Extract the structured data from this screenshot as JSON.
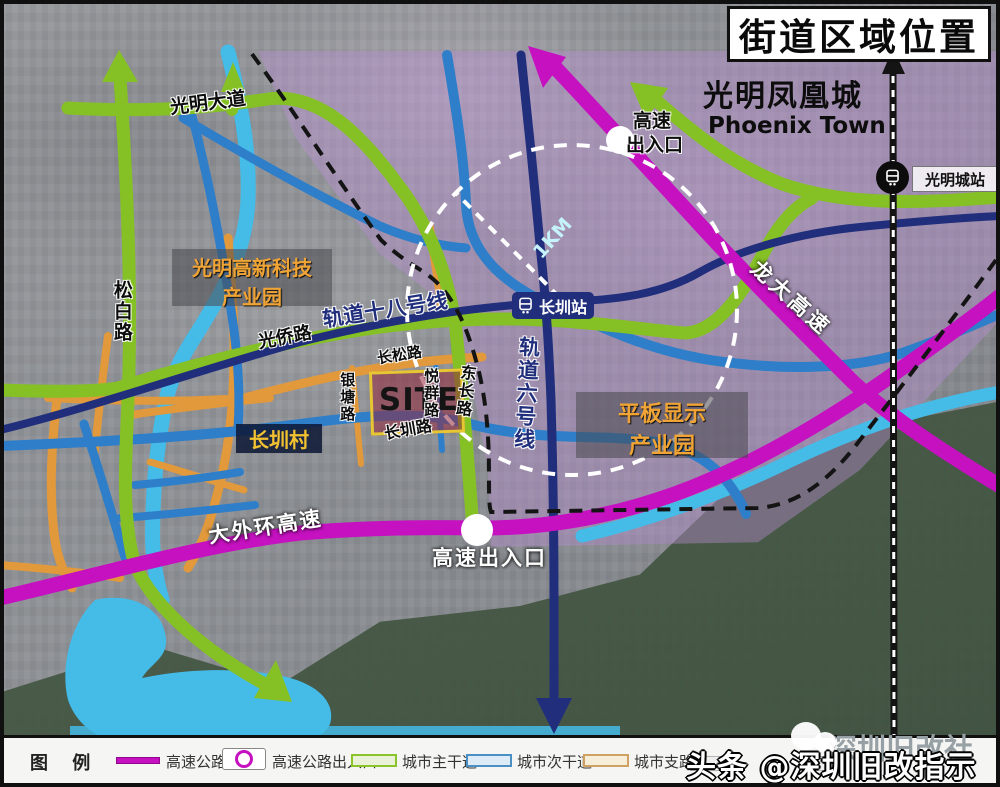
{
  "title": "街道区域位置",
  "areas": {
    "phoenix_cn": "光明凤凰城",
    "phoenix_en": "Phoenix Town",
    "hightech_park_line1": "光明高新科技",
    "hightech_park_line2": "产业园",
    "flatpanel_park_line1": "平板显示",
    "flatpanel_park_line2": "产业园",
    "changzhen_village": "长圳村",
    "site": "SITE"
  },
  "roads": {
    "guangming_avenue": "光明大道",
    "songbai_road": "松白路",
    "guangqiao_road": "光侨路",
    "changsong_road": "长松路",
    "yintang_road": "银塘路",
    "yuequn_road": "悦群路",
    "dongchang_road": "东长路",
    "changzhen_road": "长圳路",
    "dawaihuan_expressway": "大外环高速",
    "longda_expressway": "龙大高速"
  },
  "metro": {
    "line18": "轨道十八号线",
    "line6": "轨道六号线",
    "changzhen_station": "长圳站",
    "guangmingcheng_station": "光明城站"
  },
  "markers": {
    "expressway_exit_top_line1": "高速",
    "expressway_exit_top_line2": "出入口",
    "expressway_exit_bottom": "高速出入口",
    "radius_label": "1KM"
  },
  "legend": {
    "title": "图 例",
    "items": [
      {
        "label": "高速公路",
        "type": "line",
        "color": "#c511c0"
      },
      {
        "label": "高速公路出入口",
        "type": "circle",
        "color": "#c511c0"
      },
      {
        "label": "城市主干道",
        "type": "line",
        "color": "#8bc32a"
      },
      {
        "label": "城市次干道",
        "type": "line",
        "color": "#4a90c4"
      },
      {
        "label": "城市支路",
        "type": "line",
        "color": "#cfa264"
      },
      {
        "label": "",
        "type": "line",
        "color": "#cccccc"
      },
      {
        "label": "",
        "type": "line",
        "color": "#cccccc"
      }
    ]
  },
  "watermark": {
    "toutiao": "头条 @深圳旧改指示",
    "gray": "深圳旧改社"
  },
  "colors": {
    "road_main_green": "#85c125",
    "road_secondary_blue": "#2e7ec9",
    "road_branch_orange": "#e2993b",
    "expressway_magenta": "#c511c0",
    "metro_navy": "#202e7c",
    "water_cyan": "#45bbe8",
    "railway_black": "#141414",
    "site_fill": "rgba(148,38,58,0.55)",
    "site_border": "#e6c632",
    "park_label_yellow": "#f0a435",
    "village_label_yellow": "#f2c230",
    "study_area_tint": "rgba(186,144,210,0.42)"
  }
}
